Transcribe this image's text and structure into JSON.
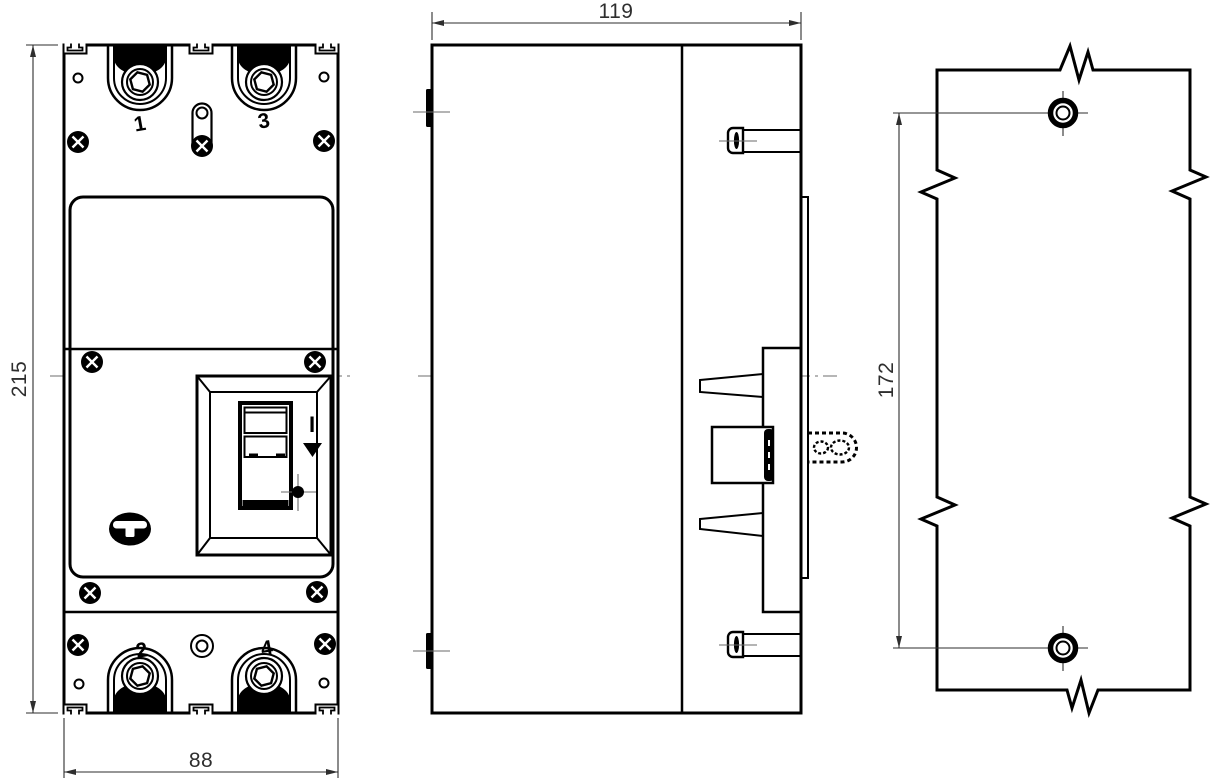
{
  "drawing": {
    "subject": "molded-case circuit breaker outline drawing",
    "dimensions": {
      "height": "215",
      "width": "88",
      "depth": "119",
      "hole_spacing": "172"
    },
    "poles": {
      "top_left": "1",
      "top_right": "3",
      "bottom_left": "2",
      "bottom_right": "4"
    },
    "switch": {
      "on_label": "I",
      "trip_icon": "down-triangle-icon",
      "push_to_trip_icon": "dot-crosshair-icon"
    },
    "colors": {
      "line": "#000000",
      "background": "#ffffff",
      "centerline": "#8a8a8a",
      "dimension": "#2e2e2e"
    }
  }
}
